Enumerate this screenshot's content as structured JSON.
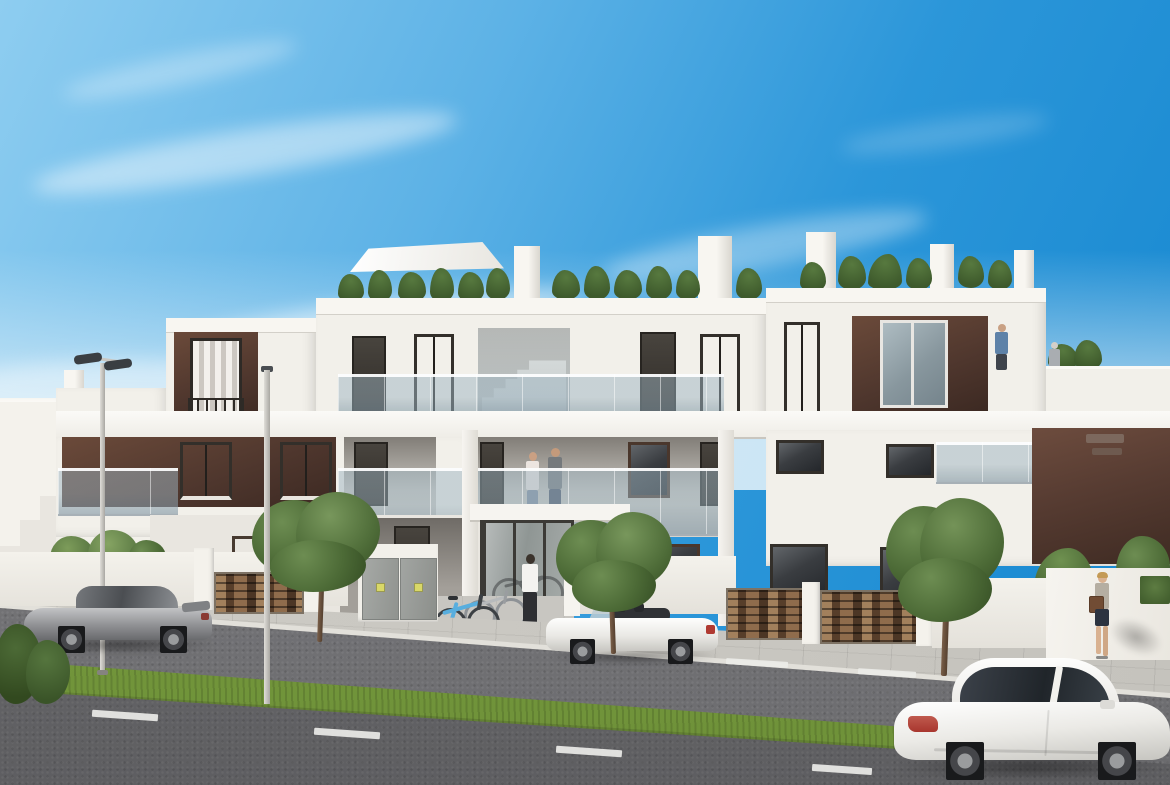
{
  "scene": {
    "description": "Sunny 3D architectural rendering of a modern three-level white apartment building with dark brown accent panels, glass balustrade balconies, rooftop plants and terrace, street lamps, three cars, bicycles and pedestrians on a residential street with a grass median",
    "setting": "residential street, daytime, clear blue sky with light wispy clouds"
  },
  "palette": {
    "sky_deep": "#1486cf",
    "sky_light": "#8ecdf0",
    "sky_horizon": "#d9edf8",
    "cloud_white": "#ffffff",
    "wall_white": "#f2f0ea",
    "wall_shade": "#dcd9d2",
    "recess_shade": "#a8a49d",
    "accent_brown": "#4e362d",
    "accent_brown_light": "#6b4a3a",
    "window_dark": "#35383c",
    "glass_balustrade": "#93aab6",
    "stone_gate_brown": "#6a4a33",
    "utility_door_gray": "#9da09d",
    "sidewalk_gray": "#c9c7c1",
    "curb_light": "#e2e0da",
    "road_gray": "#8e8e90",
    "road_foreground": "#6e6e71",
    "lane_marking_white": "#ebebe8",
    "grass_green": "#7da23f",
    "tree_green": "#53703a",
    "car_silver": "#909295",
    "car_white": "#f4f3f0",
    "taillight_red": "#b03a31",
    "bike_blue": "#58aede",
    "skin_tone": "#d9b190"
  },
  "objects": {
    "building": {
      "floors": 3,
      "style": "modern flat-roof apartment block",
      "features": [
        "rooftop plants and shade sail",
        "glass balustrades",
        "brown feature panels with curtained windows",
        "open exterior staircase",
        "glazed entrance lobby",
        "stone-slat gates",
        "gray utility cabinet doors with small yellow labels"
      ]
    },
    "vehicles": [
      {
        "name": "silver-sports-coupe",
        "color": "silver",
        "state": "parked at left curb, facing left"
      },
      {
        "name": "white-convertible",
        "color": "white",
        "state": "parked at center curb, top down, facing left"
      },
      {
        "name": "white-sport-coupe",
        "color": "white",
        "state": "driving through foreground, facing right"
      }
    ],
    "people": [
      {
        "name": "couple-on-balcony",
        "location": "first-floor walkway behind glass balustrade"
      },
      {
        "name": "man-at-entrance",
        "location": "walking toward glazed entrance, white shirt"
      },
      {
        "name": "man-on-roof-terrace",
        "location": "upper right terrace, blue shirt"
      },
      {
        "name": "person-on-roof-terrace",
        "location": "far right rooftop terrace, gray"
      },
      {
        "name": "woman-on-sidewalk",
        "location": "right sidewalk, walking left with brown handbag"
      }
    ],
    "street": {
      "lamps": 2,
      "bicycles": 2,
      "trees": 3,
      "median": "grass strip",
      "lane_markings": "white dashes on both carriageways"
    }
  }
}
